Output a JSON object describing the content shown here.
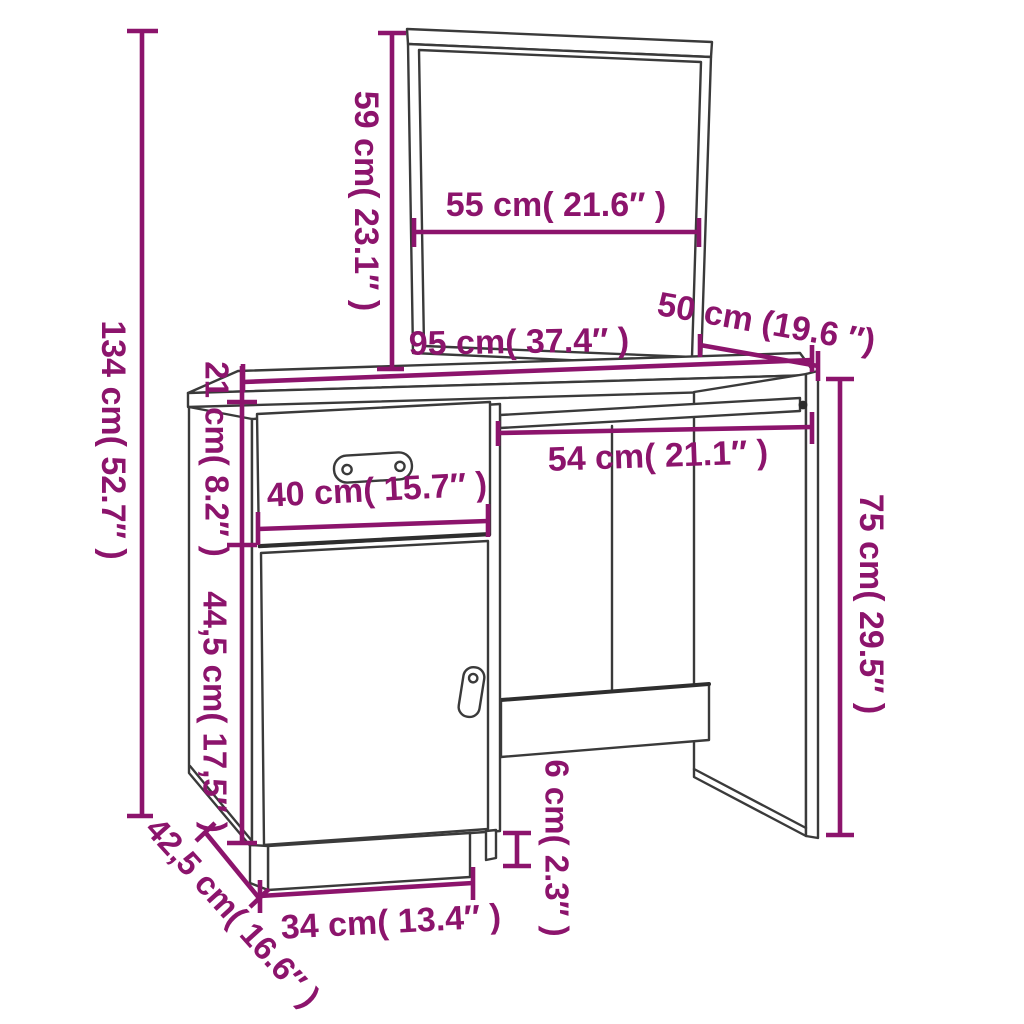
{
  "page": {
    "title": "Dressing table with mirror - dimension diagram",
    "background_color": "#ffffff"
  },
  "style": {
    "dimension_color": "#8C146C",
    "furniture_line_color": "#3A3A3A",
    "label_font_size": 34
  },
  "product": {
    "name": "dressing-table-with-mirror",
    "parts": [
      "mirror",
      "desktop",
      "drawer",
      "cabinet-door",
      "right-side-panel",
      "modesty-panel",
      "plinth"
    ]
  },
  "dimensions": [
    {
      "name": "total-height",
      "label": "134 cm( 52.7″ )",
      "label_x": 111,
      "label_y": 440,
      "rotate": 90,
      "font_size": 34,
      "lines": [
        [
          142,
          31,
          142,
          816
        ]
      ],
      "caps": [
        [
          127,
          31,
          158,
          31
        ],
        [
          127,
          816,
          153,
          816
        ]
      ]
    },
    {
      "name": "mirror-height",
      "label": "59 cm( 23.1″ )",
      "label_x": 364,
      "label_y": 201,
      "rotate": 90,
      "font_size": 34,
      "lines": [
        [
          392,
          33,
          392,
          369
        ]
      ],
      "caps": [
        [
          378,
          33,
          406,
          33
        ],
        [
          377,
          369,
          404,
          369
        ]
      ]
    },
    {
      "name": "mirror-width",
      "label": "55 cm( 21.6″ )",
      "label_x": 556,
      "label_y": 207,
      "rotate": 0,
      "font_size": 34,
      "lines": [
        [
          414,
          232,
          699,
          232
        ]
      ],
      "caps": [
        [
          414,
          218,
          414,
          247
        ],
        [
          699,
          218,
          699,
          247
        ]
      ]
    },
    {
      "name": "desktop-width",
      "label": "95 cm( 37.4″ )",
      "label_x": 519,
      "label_y": 344,
      "rotate": -1,
      "font_size": 34,
      "lines": [
        [
          243,
          382,
          812,
          360
        ]
      ],
      "caps": [
        [
          243,
          364,
          243,
          392
        ],
        [
          812,
          345,
          812,
          372
        ]
      ]
    },
    {
      "name": "desktop-depth",
      "label": "50 cm (19.6 ″)",
      "label_x": 766,
      "label_y": 325,
      "rotate": 10,
      "font_size": 34,
      "lines": [
        [
          700,
          345,
          818,
          366
        ]
      ],
      "caps": [
        [
          700,
          334,
          700,
          357
        ],
        [
          818,
          351,
          818,
          381
        ]
      ]
    },
    {
      "name": "drawer-section-height",
      "label": "21 cm( 8.2″ )",
      "label_x": 214,
      "label_y": 459,
      "rotate": 90,
      "font_size": 33,
      "lines": [
        [
          242,
          366,
          242,
          545
        ]
      ],
      "caps": [
        [
          227,
          402,
          257,
          402
        ],
        [
          227,
          545,
          257,
          545
        ]
      ]
    },
    {
      "name": "door-height",
      "label": "44,5 cm( 17,5″ )",
      "label_x": 212,
      "label_y": 712,
      "rotate": 90,
      "font_size": 33,
      "lines": [
        [
          242,
          545,
          242,
          843
        ]
      ],
      "caps": [
        [
          227,
          843,
          257,
          843
        ]
      ]
    },
    {
      "name": "drawer-width",
      "label": "40 cm( 15.7″ )",
      "label_x": 377,
      "label_y": 492,
      "rotate": -3,
      "font_size": 34,
      "lines": [
        [
          258,
          529,
          488,
          521
        ]
      ],
      "caps": [
        [
          258,
          512,
          258,
          545
        ],
        [
          488,
          504,
          488,
          537
        ]
      ]
    },
    {
      "name": "knee-space-width",
      "label": "54 cm( 21.1″ )",
      "label_x": 658,
      "label_y": 458,
      "rotate": -2,
      "font_size": 34,
      "lines": [
        [
          498,
          433,
          812,
          427
        ]
      ],
      "caps": [
        [
          498,
          421,
          498,
          446
        ],
        [
          812,
          412,
          812,
          444
        ]
      ]
    },
    {
      "name": "desk-height",
      "label": "75 cm( 29.5″ )",
      "label_x": 869,
      "label_y": 604,
      "rotate": 90,
      "font_size": 34,
      "lines": [
        [
          840,
          379,
          840,
          835
        ]
      ],
      "caps": [
        [
          826,
          379,
          854,
          379
        ],
        [
          826,
          835,
          854,
          835
        ]
      ]
    },
    {
      "name": "foot-height",
      "label": "6 cm( 2.3″ )",
      "label_x": 554,
      "label_y": 848,
      "rotate": 90,
      "font_size": 33,
      "lines": [
        [
          517,
          833,
          517,
          866
        ]
      ],
      "caps": [
        [
          503,
          833,
          531,
          833
        ],
        [
          503,
          866,
          531,
          866
        ]
      ]
    },
    {
      "name": "plinth-width",
      "label": "34 cm( 13.4″ )",
      "label_x": 391,
      "label_y": 924,
      "rotate": -3,
      "font_size": 34,
      "lines": [
        [
          260,
          896,
          473,
          883
        ]
      ],
      "caps": [
        [
          260,
          880,
          260,
          913
        ],
        [
          473,
          867,
          473,
          900
        ]
      ]
    },
    {
      "name": "cabinet-depth",
      "label": "42,5 cm( 16.6″ )",
      "label_x": 231,
      "label_y": 914,
      "rotate": 48,
      "font_size": 33,
      "lines": [
        [
          205,
          832,
          259,
          898
        ]
      ],
      "caps": [
        [
          196,
          841,
          215,
          823
        ],
        [
          250,
          907,
          269,
          889
        ]
      ]
    }
  ]
}
